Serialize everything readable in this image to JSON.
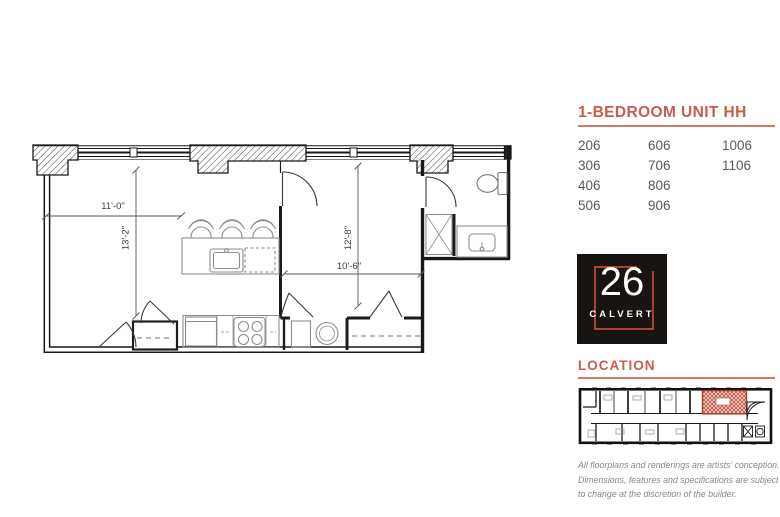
{
  "plan": {
    "dimensions": {
      "living_width": "11'-0\"",
      "living_depth": "13'-2\"",
      "bedroom_depth": "12'-8\"",
      "bedroom_width": "10'-6\""
    }
  },
  "sidebar": {
    "title": "1-BEDROOM UNIT HH",
    "units_columns": [
      [
        "206",
        "306",
        "406",
        "506"
      ],
      [
        "606",
        "706",
        "806",
        "906"
      ],
      [
        "1006",
        "1106"
      ]
    ],
    "logo": {
      "number": "26",
      "name": "CALVERT"
    },
    "location_label": "LOCATION",
    "disclaimer_lines": [
      "All floorplans and renderings are artists’ conception.",
      "Dimensions, features and specifications are subject",
      "to change at the discretion of the builder."
    ]
  },
  "colors": {
    "accent": "#c75d4b",
    "logo_frame": "#c14b35",
    "unit_text": "#58595b",
    "disclaimer_text": "#86888b",
    "highlight": "#c0503e"
  }
}
